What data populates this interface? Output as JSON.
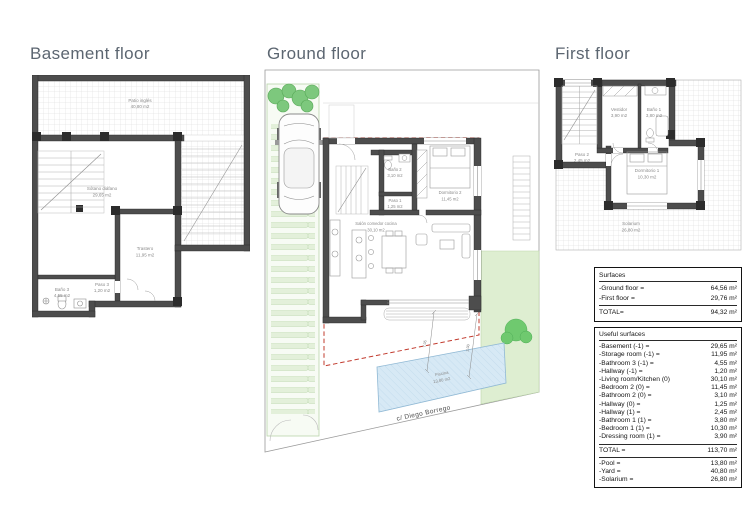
{
  "panels": {
    "basement": {
      "title": "Basement floor",
      "rooms": [
        {
          "name": "Patio inglés",
          "area": "40,80 m2"
        },
        {
          "name": "Sótano diáfano",
          "area": "29,65 m2"
        },
        {
          "name": "Trastero",
          "area": "11,95 m2"
        },
        {
          "name": "Paso 3",
          "area": "1,20 m2"
        },
        {
          "name": "Baño 3",
          "area": "4,55 m2"
        }
      ]
    },
    "ground": {
      "title": "Ground floor",
      "street_label": "c/ Diego Borrego",
      "dimensions": [
        "7,05",
        "2,00"
      ],
      "rooms": [
        {
          "name": "Baño 2",
          "area": "3,10 m2"
        },
        {
          "name": "Paso 1",
          "area": "1,25 m2"
        },
        {
          "name": "Dormitorio 2",
          "area": "11,45 m2"
        },
        {
          "name": "Salón comedor cocina",
          "area": "30,10 m2"
        },
        {
          "name": "Piscina",
          "area": "13,80 m2"
        }
      ]
    },
    "first": {
      "title": "First floor",
      "rooms": [
        {
          "name": "Vestidor",
          "area": "3,90 m2"
        },
        {
          "name": "Baño 1",
          "area": "3,80 m2"
        },
        {
          "name": "Paso 2",
          "area": "2,45 m2"
        },
        {
          "name": "Dormitorio 1",
          "area": "10,30 m2"
        },
        {
          "name": "Solarium",
          "area": "26,80 m2"
        }
      ]
    }
  },
  "tables": {
    "surfaces": {
      "title": "Surfaces",
      "rows": [
        {
          "label": "-Ground floor =",
          "value": "64,56 m²"
        },
        {
          "label": "-First floor =",
          "value": "29,76 m²"
        }
      ],
      "total_label": "TOTAL=",
      "total_value": "94,32 m²"
    },
    "useful": {
      "title": "Useful surfaces",
      "rows": [
        {
          "label": "-Basement (-1) =",
          "value": "29,65 m²"
        },
        {
          "label": "-Storage room (-1) =",
          "value": "11,95 m²"
        },
        {
          "label": "-Bathroom 3 (-1) =",
          "value": "4,55 m²"
        },
        {
          "label": "-Hallway (-1) =",
          "value": "1,20 m²"
        },
        {
          "label": "-Living room/Kitchen (0)",
          "value": "30,10 m²"
        },
        {
          "label": "-Bedroom 2 (0) =",
          "value": "11,45 m²"
        },
        {
          "label": "-Bathroom 2 (0) =",
          "value": "3,10 m²"
        },
        {
          "label": "-Hallway (0) =",
          "value": "1,25 m²"
        },
        {
          "label": "-Hallway (1) =",
          "value": "2,45 m²"
        },
        {
          "label": "-Bathroom 1 (1) =",
          "value": "3,80 m²"
        },
        {
          "label": "-Bedroom 1 (1) =",
          "value": "10,30 m²"
        },
        {
          "label": "-Dressing room (1) =",
          "value": "3,90 m²"
        }
      ],
      "total_label": "TOTAL =",
      "total_value": "113,70 m²",
      "extra": [
        {
          "label": "-Pool =",
          "value": "13,80 m²"
        },
        {
          "label": "-Yard =",
          "value": "40,80 m²"
        },
        {
          "label": "-Solarium =",
          "value": "26,80 m²"
        }
      ]
    }
  },
  "colors": {
    "title_text": "#5c6671",
    "wall": "#4d4d4d",
    "red_dash": "#c23b2e",
    "pool": "#d7e9f5",
    "garden": "#deeed1",
    "bush": "#7dc87d"
  }
}
